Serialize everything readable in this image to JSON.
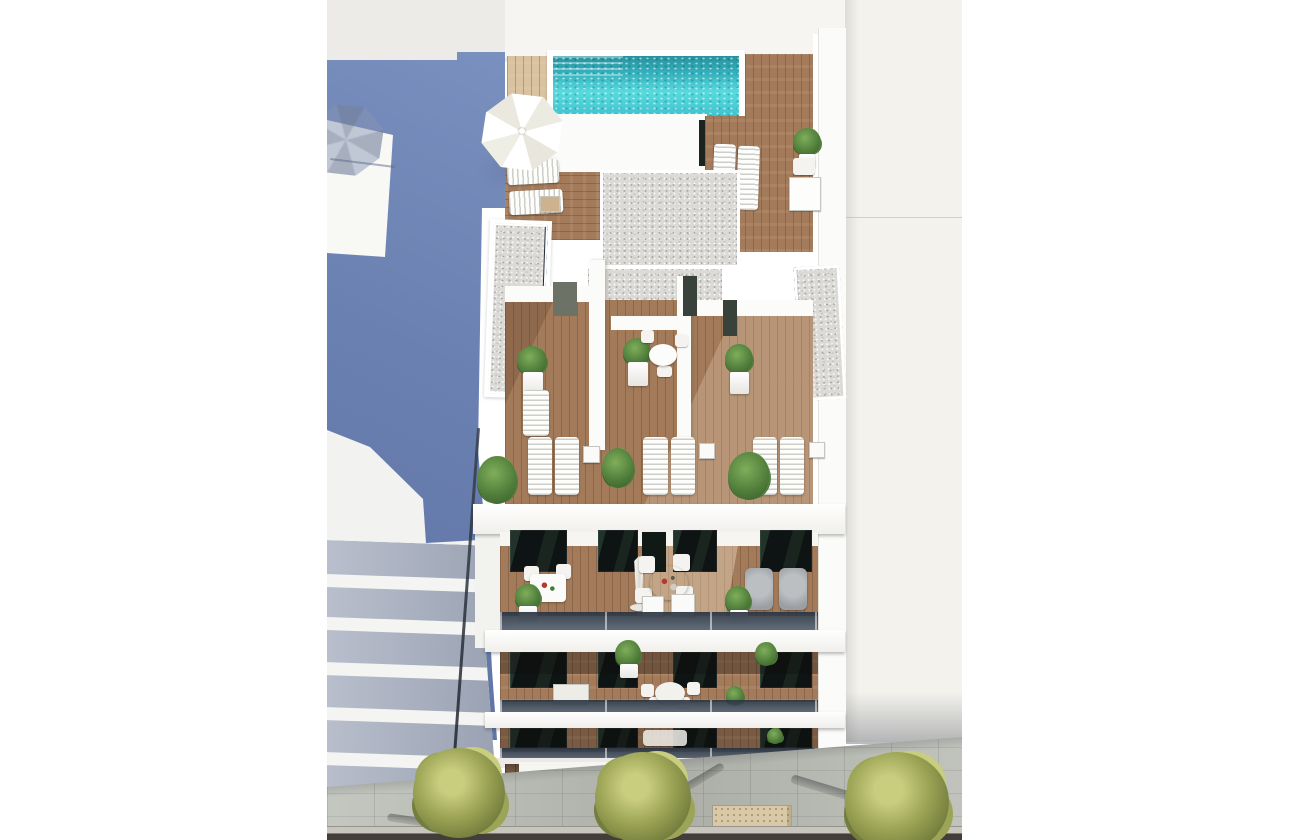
{
  "scene": {
    "description": "Aerial 3D architectural rendering of a modern white apartment building with a rooftop swimming pool, timber sun decks, penthouse terraces, stacked balconies and a tree-lined sidewalk below",
    "type": "architectural-render",
    "view": "top-down aerial"
  },
  "palette": {
    "page_bg": "#ffffff",
    "sky": "#ECEBE7",
    "blue_a": "#7A90BF",
    "blue_b": "#5E73A3",
    "white_wall": "#FBFBF9",
    "soft_white": "#FDFDFB",
    "warm_white": "#F6F5F1",
    "neighbor_white": "#F3F2ED",
    "pool_a": "#27929F",
    "pool_b": "#3FC4CE",
    "pool_c": "#58DADE",
    "wood": "#A37B5B",
    "tan_wood": "#D8C2A0",
    "gravel": "#DBDAD6",
    "gravel_dot_a": "#A3A39F",
    "gravel_dot_b": "#C2C2BD",
    "edge_navy": "#232E3B",
    "win_a": "#0D1413",
    "glass_a": "#2A3440",
    "glass_b": "#5A6674",
    "slab_grey_a": "#B9BFCC",
    "slab_grey_b": "#99A1B2",
    "plant_a": "#4F7C3A",
    "plant_b": "#7FAE5A",
    "plant_dark": "#3A5E2C",
    "tree_a": "#C9CE7E",
    "tree_b": "#9CA455",
    "tree_dark": "#737D3C",
    "pavement": "#B9BCB4",
    "tactile": "#D9C9A6",
    "curb": "#C8C5BC",
    "road": "#433E39",
    "cladding": "#6F5440",
    "cladding_light": "#8A6B52",
    "furn_grey": "#9B9EA2",
    "shadow_blue": "#76839F"
  },
  "objects": {
    "rooftop": {
      "swimming_pool": 1,
      "open_parasol": 1,
      "sun_loungers": 4,
      "side_tables": 2,
      "potted_plants": 2,
      "gravel_roof_sections": 5,
      "timber_deck": true
    },
    "penthouse_terraces": {
      "count": 3,
      "sun_loungers": 6,
      "side_tables": 3,
      "potted_plants": 6,
      "lounge_chair": 1,
      "small_table_set": 1
    },
    "balcony_levels": {
      "count": 3,
      "level_1": {
        "bistro_set": 1,
        "round_dining_table": 1,
        "dining_chairs": 4,
        "closed_parasol": 1,
        "lounge_armchairs": 2,
        "potted_plants": 2,
        "dark_window_openings": 4
      },
      "level_2": {
        "dining_set": 1,
        "potted_plants": 3
      },
      "level_3": {
        "partially_visible": true
      }
    },
    "street": {
      "trees": 3,
      "tree_grates": 3,
      "tactile_paving_strip": 1,
      "stone_paved_sidewalk": true,
      "road_edge": true
    },
    "surroundings": {
      "left_neighbor": "blue side wall with parasol shadow and stacked white balconies",
      "right_neighbor": "tall off-white residential block"
    }
  }
}
